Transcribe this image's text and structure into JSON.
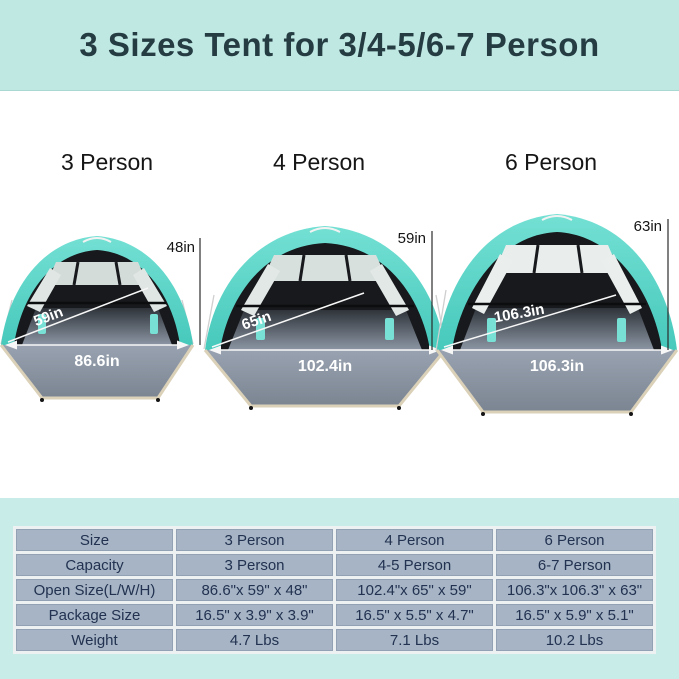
{
  "header": {
    "title": "3 Sizes Tent for 3/4-5/6-7 Person"
  },
  "colors": {
    "header_bg": "#bfe8e3",
    "header_text": "#243c42",
    "tent_teal": "#56d2c5",
    "tent_interior": "#17191c",
    "floor_gray": "#8c96a4",
    "floor_trim_tan": "#dbd1b8",
    "section_bg": "#c8ece7",
    "table_cell_bg": "#a6b4c5",
    "table_text": "#223250"
  },
  "tents": [
    {
      "label": "3 Person",
      "height": "48in",
      "depth": "59in",
      "width": "86.6in"
    },
    {
      "label": "4 Person",
      "height": "59in",
      "depth": "65in",
      "width": "102.4in"
    },
    {
      "label": "6 Person",
      "height": "63in",
      "depth": "106.3in",
      "width": "106.3in"
    }
  ],
  "table": {
    "rows": [
      {
        "label": "Size",
        "values": [
          "3 Person",
          "4 Person",
          "6 Person"
        ]
      },
      {
        "label": "Capacity",
        "values": [
          "3 Person",
          "4-5 Person",
          "6-7 Person"
        ]
      },
      {
        "label": "Open Size(L/W/H)",
        "values": [
          "86.6\"x 59\" x 48\"",
          "102.4\"x 65\" x 59\"",
          "106.3\"x 106.3\" x 63\""
        ]
      },
      {
        "label": "Package Size",
        "values": [
          "16.5\" x 3.9\" x 3.9\"",
          "16.5\" x 5.5\" x 4.7\"",
          "16.5\" x 5.9\" x 5.1\""
        ]
      },
      {
        "label": "Weight",
        "values": [
          "4.7 Lbs",
          "7.1 Lbs",
          "10.2 Lbs"
        ]
      }
    ]
  }
}
